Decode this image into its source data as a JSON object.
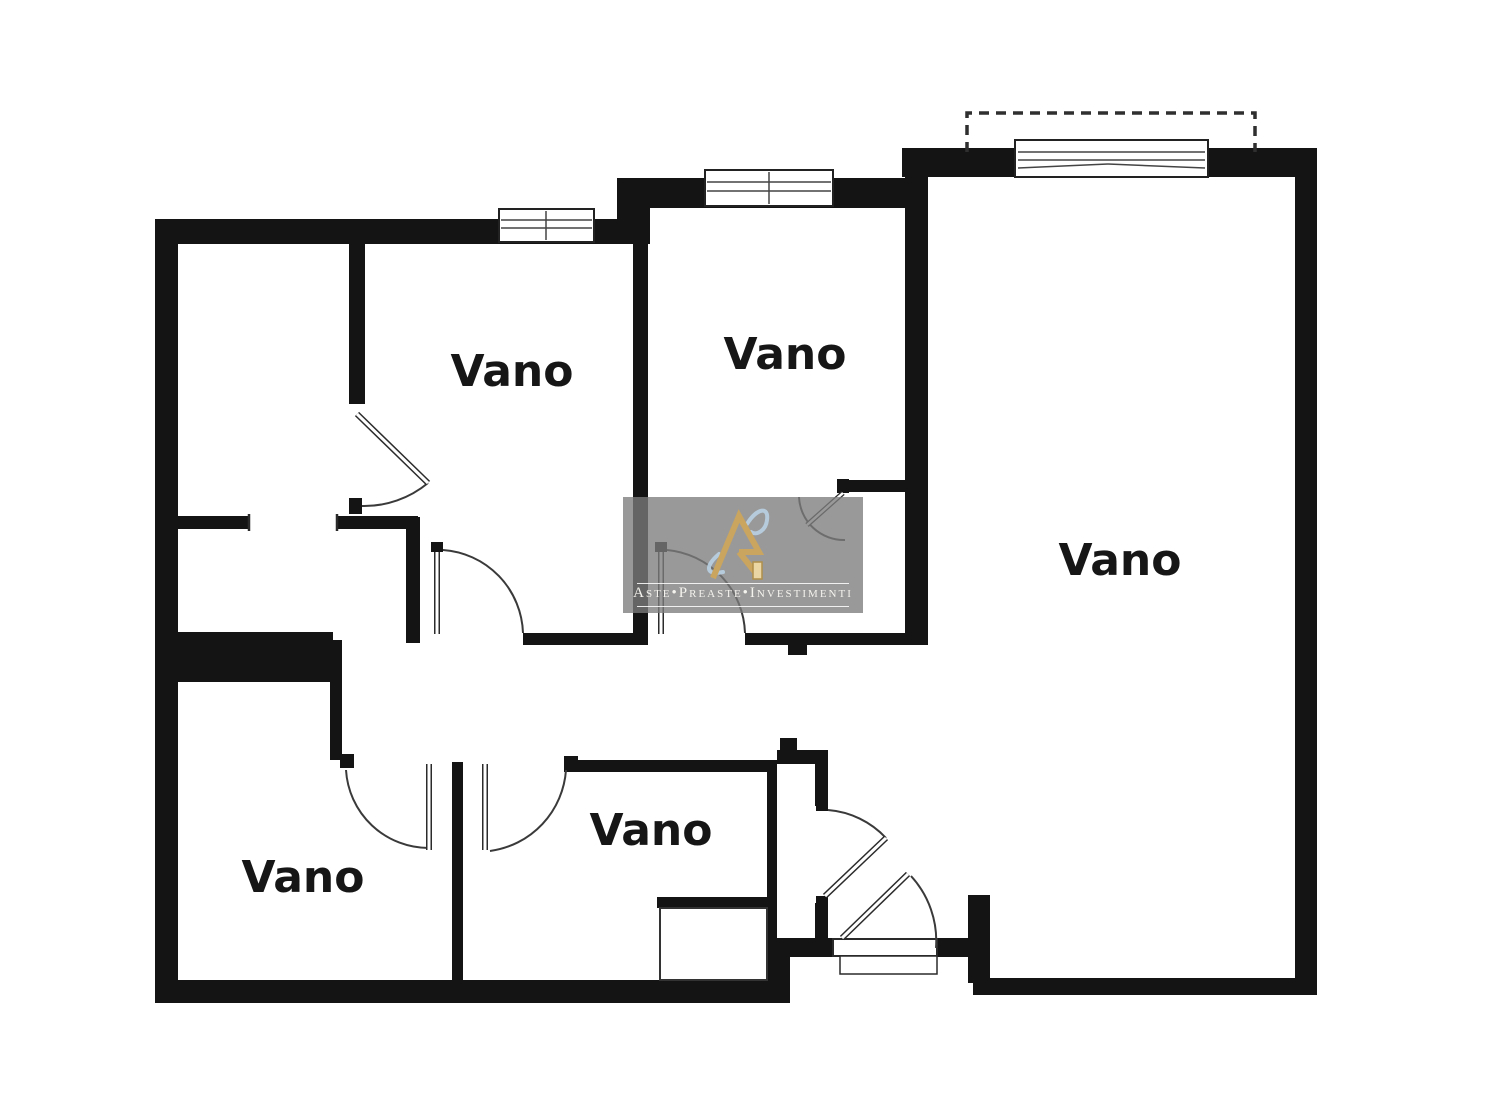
{
  "page": {
    "type": "apartment-floor-plan",
    "background": "#ffffff"
  },
  "plan": {
    "wall_color": "#141414",
    "thin_line_color": "#3a3a3a",
    "room_label_color": "#161616",
    "features": [
      "windows",
      "door-swings",
      "dashed-balcony-outline",
      "entrance-threshold"
    ]
  },
  "rooms": [
    {
      "id": "room-top-left",
      "label": "Vano"
    },
    {
      "id": "room-top-middle",
      "label": "Vano"
    },
    {
      "id": "room-right-large",
      "label": "Vano"
    },
    {
      "id": "room-bottom-left",
      "label": "Vano"
    },
    {
      "id": "room-bottom-middle",
      "label": "Vano"
    }
  ],
  "watermark": {
    "brand_text": "Aste•Preaste•Investimenti",
    "panel_color": "rgba(124,124,124,0.78)",
    "logo_gold": "#c9a55f",
    "logo_gold_light": "#e9d6a4",
    "swoosh_blue": "#b9d0e2",
    "text_color": "#f5f3ee"
  }
}
